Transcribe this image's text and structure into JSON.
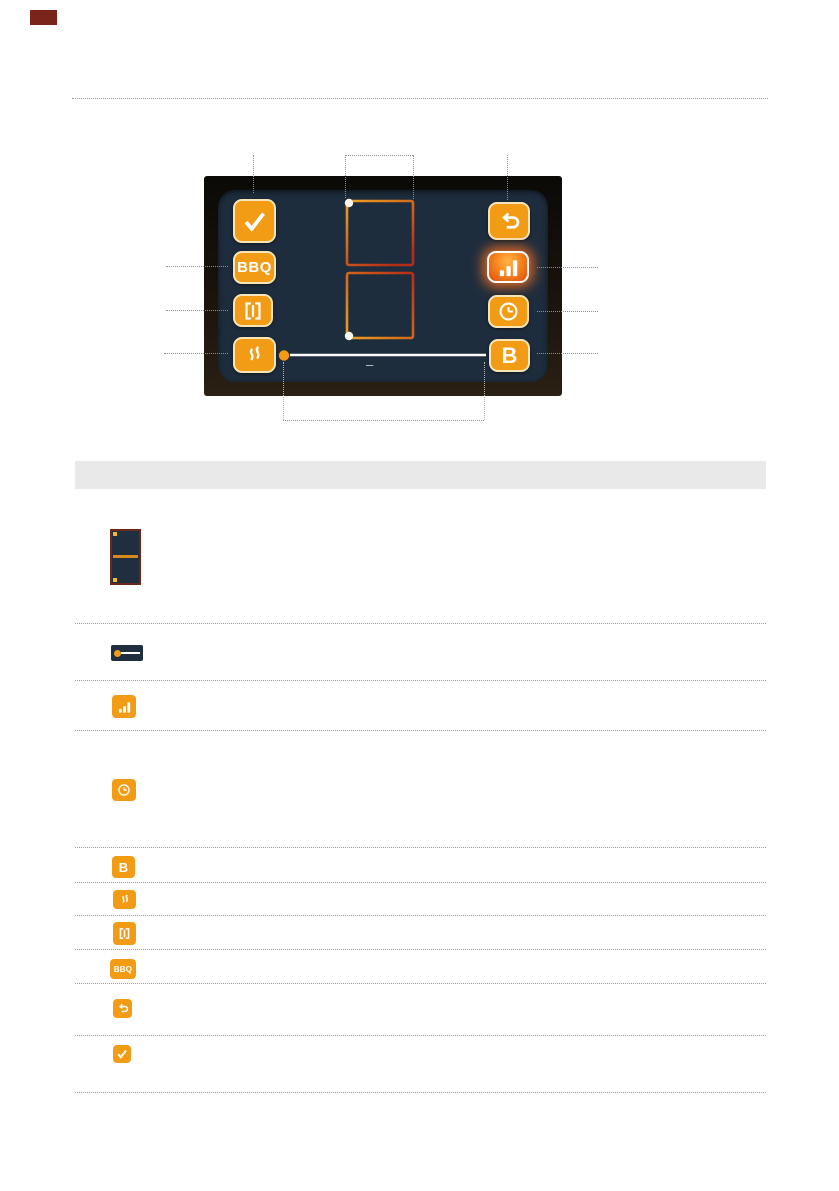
{
  "panel": {
    "buttons": {
      "confirm": {
        "icon": "checkmark-icon",
        "label": ""
      },
      "bbq": {
        "icon": "bbq-text-icon",
        "label": "BBQ"
      },
      "bridge": {
        "icon": "bridge-icon",
        "label": ""
      },
      "flame": {
        "icon": "flame-icon",
        "label": ""
      },
      "back": {
        "icon": "return-arrow-icon",
        "label": ""
      },
      "power": {
        "icon": "power-level-bars-icon",
        "label": "",
        "state": "active"
      },
      "timer": {
        "icon": "clock-icon",
        "label": ""
      },
      "booster": {
        "icon": "b-letter-icon",
        "label": "B"
      }
    },
    "slider": {
      "minus_label": "–"
    }
  },
  "legend": {
    "header_text": "",
    "rows": [
      {
        "icon": "dual-zone-display-icon",
        "label": ""
      },
      {
        "icon": "slider-icon",
        "label": ""
      },
      {
        "icon": "power-level-bars-icon",
        "label": ""
      },
      {
        "icon": "clock-icon",
        "label": ""
      },
      {
        "icon": "b-letter-icon",
        "label": "B"
      },
      {
        "icon": "flame-icon",
        "label": ""
      },
      {
        "icon": "bridge-icon",
        "label": ""
      },
      {
        "icon": "bbq-text-icon",
        "label": "BBQ"
      },
      {
        "icon": "return-arrow-icon",
        "label": ""
      },
      {
        "icon": "checkmark-icon",
        "label": ""
      }
    ]
  },
  "colors": {
    "orange": "#f29c16",
    "btn-border": "#f7e5ba",
    "panel-bg": "#1e2d3d",
    "header-bar": "#e9e9e9",
    "callout": "#8f8f8f",
    "corner": "#7b241c",
    "zone_gradient_start": "#efa01e",
    "zone_gradient_end": "#b72c18"
  }
}
